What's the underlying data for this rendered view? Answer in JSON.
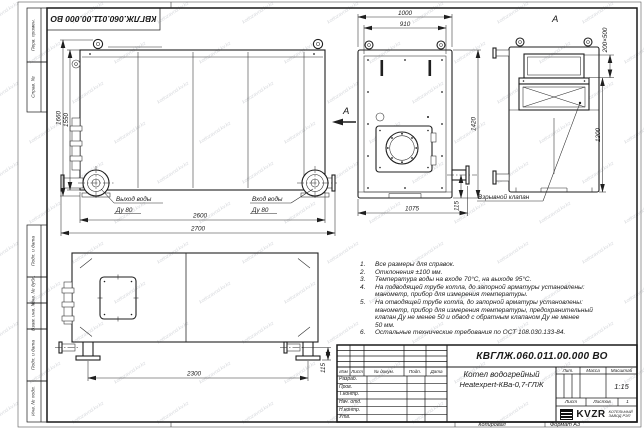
{
  "title_block": {
    "designation": "КВГЛЖ.060.011.00.000 ВО",
    "name_line1": "Котел водогрейный",
    "name_line2": "Heatexpert-КВа-0,7-ГЛЖ",
    "header_cols": [
      "Изм",
      "Лист",
      "№ докум.",
      "Подп.",
      "Дата"
    ],
    "rows": [
      "Разраб.",
      "Пров.",
      "Т.контр.",
      "Нач. отд.",
      "Н.контр.",
      "Утв."
    ],
    "lit_label": "Лит.",
    "mass_label": "Масса",
    "scale_label": "Масштаб",
    "scale_value": "1:15",
    "sheet_label": "Лист",
    "sheets_label": "Листов",
    "sheets_value": "1",
    "logo_text": "KVZR",
    "logo_sub1": "КОТЕЛЬНЫЙ",
    "logo_sub2": "ЗАВОД РЭП"
  },
  "frame": {
    "left_labels": [
      "Перв. примен.",
      "Справ. №",
      "Подп. и дата",
      "Инв. № дубл.",
      "Взам. инв. №",
      "Подп. и дата",
      "Инв. № подл."
    ],
    "copy_label": "Копировал",
    "format_label": "Формат А3"
  },
  "views": {
    "side": {
      "dims": {
        "h_outer": "1660",
        "h_inner": "1550",
        "w_inner": "2600",
        "w_outer": "2700"
      },
      "outlet1": "Выход воды",
      "outlet2": "Ду 80",
      "inlet1": "Вход воды",
      "inlet2": "Ду 80",
      "section_label": "А"
    },
    "front": {
      "dims": {
        "w_outer": "1000",
        "w_inner": "910",
        "height": "1420",
        "bottom": "1075",
        "pipe": "115"
      }
    },
    "viewA": {
      "title": "А",
      "dims": {
        "opening": "200×500",
        "height": "1200"
      },
      "valve_label": "Взрывной клапан"
    },
    "plan": {
      "dims": {
        "span": "2300",
        "pipe": "115"
      }
    }
  },
  "notes": {
    "items": [
      {
        "num": "1.",
        "l0": "Все размеры для справок."
      },
      {
        "num": "2.",
        "l0": "Отклонения ±100 мм."
      },
      {
        "num": "3.",
        "l0": "Температура воды на входе 70°С, на выходе 95°С."
      },
      {
        "num": "4.",
        "l0": "На подводящей трубе котла, до запорной арматуры установлены:",
        "l1": "манометр, прибор для измерения температуры."
      },
      {
        "num": "5.",
        "l0": "На отводящей трубе котла, до запорной арматуры установлены:",
        "l1": "манометр, прибор для измерения температуры, предохранительный",
        "l2": "клапан Ду не менее 50 и обвод с обратным клапаном Ду не менее",
        "l3": "50 мм."
      },
      {
        "num": "6.",
        "l0": "Остальные технические требования по ОСТ 108.030.133-84."
      }
    ]
  },
  "watermark": {
    "text": "kotlozavod.kv.kz"
  }
}
